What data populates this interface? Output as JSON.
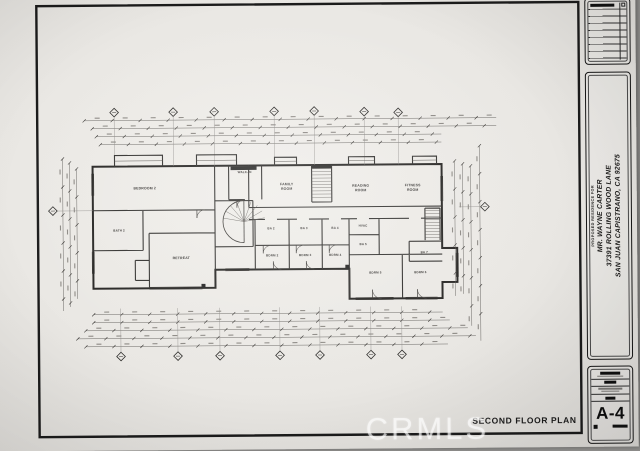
{
  "sheet": {
    "footer_title": "SECOND FLOOR PLAN",
    "sheet_number": "A-4",
    "watermark": "CRMLS"
  },
  "title_block": {
    "prepared_for": "PROPOSED RESIDENCE FOR",
    "client_name": "MR. WAYNE CARTER",
    "address_line1": "37391 ROLLING WOOD LANE",
    "address_line2": "SAN JUAN CAPISTRANO, CA 92675"
  },
  "plan": {
    "rooms": [
      {
        "label": "BEDROOM 2"
      },
      {
        "label": "WALK-IN"
      },
      {
        "label": "BATH 2"
      },
      {
        "label": "RETREAT"
      },
      {
        "label": "FAMILY",
        "label2": "ROOM"
      },
      {
        "label": "READING",
        "label2": "ROOM"
      },
      {
        "label": "FITNESS",
        "label2": "ROOM"
      },
      {
        "label": "BA 2"
      },
      {
        "label": "BA 3"
      },
      {
        "label": "BA 4"
      },
      {
        "label": "HVAC"
      },
      {
        "label": "BA 5"
      },
      {
        "label": "BA 7"
      },
      {
        "label": "BDRM 2"
      },
      {
        "label": "BDRM 3"
      },
      {
        "label": "BDRM 4"
      },
      {
        "label": "BDRM 5"
      },
      {
        "label": "BDRM 6"
      }
    ]
  },
  "colors": {
    "paper": "#eae8e4",
    "ink": "#1c1c1c",
    "pencil": "#55524e",
    "background": "#8b8a88",
    "watermark": "rgba(255,255,255,0.58)"
  }
}
